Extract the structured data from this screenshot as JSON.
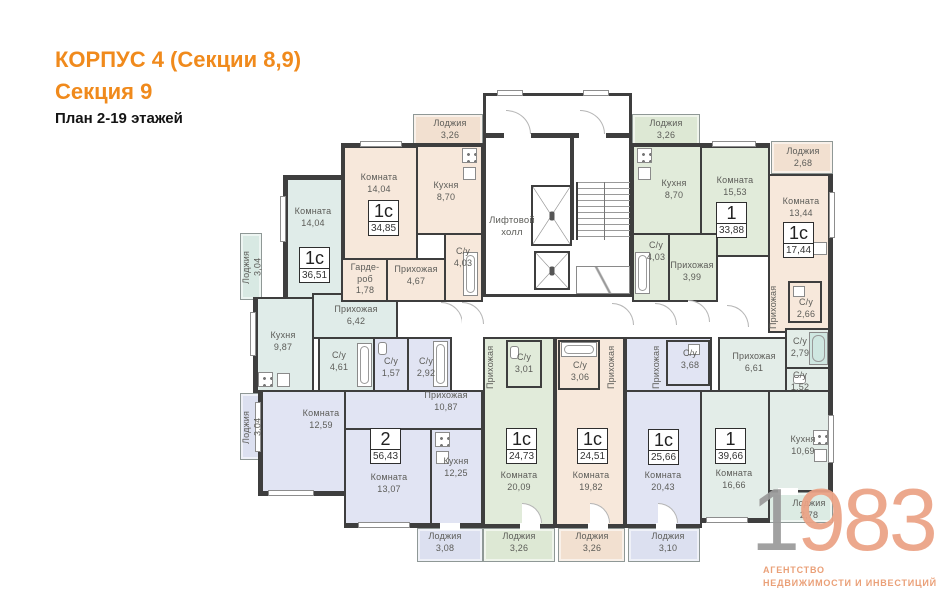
{
  "title": {
    "line1": "КОРПУС 4 (Секции 8,9)",
    "line2": "Секция 9",
    "line3": "План 2-19 этажей"
  },
  "plan": {
    "lift_hall": "Лифтовой холл",
    "apartments": {
      "a3651": {
        "type": "1с",
        "area": "36,51"
      },
      "a3485": {
        "type": "1с",
        "area": "34,85"
      },
      "a3388": {
        "type": "1",
        "area": "33,88"
      },
      "a1744": {
        "type": "1с",
        "area": "17,44"
      },
      "a5643": {
        "type": "2",
        "area": "56,43"
      },
      "a2473": {
        "type": "1с",
        "area": "24,73"
      },
      "a2451": {
        "type": "1с",
        "area": "24,51"
      },
      "a2566": {
        "type": "1с",
        "area": "25,66"
      },
      "a3966": {
        "type": "1",
        "area": "39,66"
      }
    },
    "rooms": {
      "komnataA": {
        "name": "Комната",
        "area": "14,04"
      },
      "lodge304t": {
        "name": "Лоджия",
        "area": "3,04"
      },
      "kuhnya987": {
        "name": "Кухня",
        "area": "9,87"
      },
      "prihozhaya642": {
        "name": "Прихожая",
        "area": "6,42"
      },
      "su461": {
        "name": "С/у",
        "area": "4,61"
      },
      "lodge326tl": {
        "name": "Лоджия",
        "area": "3,26"
      },
      "komnataB": {
        "name": "Комната",
        "area": "14,04"
      },
      "kuhnya870l": {
        "name": "Кухня",
        "area": "8,70"
      },
      "garderob178": {
        "name": "Гарде-роб",
        "area": "1,78"
      },
      "prihozhaya467": {
        "name": "Прихожая",
        "area": "4,67"
      },
      "su403l": {
        "name": "С/у",
        "area": "4,03"
      },
      "lodge326tr": {
        "name": "Лоджия",
        "area": "3,26"
      },
      "kuhnya870r": {
        "name": "Кухня",
        "area": "8,70"
      },
      "komnata1553": {
        "name": "Комната",
        "area": "15,53"
      },
      "su403r": {
        "name": "С/у",
        "area": "4,03"
      },
      "prihozhaya399": {
        "name": "Прихожая",
        "area": "3,99"
      },
      "lodge268": {
        "name": "Лоджия",
        "area": "2,68"
      },
      "komnata1344": {
        "name": "Комната",
        "area": "13,44"
      },
      "prihozhaya1744": {
        "name": "Прихожая",
        "area": ""
      },
      "su266": {
        "name": "С/у",
        "area": "2,66"
      },
      "su279": {
        "name": "С/у",
        "area": "2,79"
      },
      "su152": {
        "name": "С/у",
        "area": "1,52"
      },
      "prihozhaya661": {
        "name": "Прихожая",
        "area": "6,61"
      },
      "kuhnya1069": {
        "name": "Кухня",
        "area": "10,69"
      },
      "komnata1666": {
        "name": "Комната",
        "area": "16,66"
      },
      "lodge278": {
        "name": "Лоджия",
        "area": "2,78"
      },
      "komnata1259": {
        "name": "Комната",
        "area": "12,59"
      },
      "lodge304b": {
        "name": "Лоджия",
        "area": "3,04"
      },
      "su157": {
        "name": "С/у",
        "area": "1,57"
      },
      "su292": {
        "name": "С/у",
        "area": "2,92"
      },
      "prihozhaya1087": {
        "name": "Прихожая",
        "area": "10,87"
      },
      "komnata1307": {
        "name": "Комната",
        "area": "13,07"
      },
      "kuhnya1225": {
        "name": "Кухня",
        "area": "12,25"
      },
      "lodge308": {
        "name": "Лоджия",
        "area": "3,08"
      },
      "prihozhayaV1": {
        "name": "Прихожая",
        "area": ""
      },
      "su301": {
        "name": "С/у",
        "area": "3,01"
      },
      "komnata2009": {
        "name": "Комната",
        "area": "20,09"
      },
      "lodge326b1": {
        "name": "Лоджия",
        "area": "3,26"
      },
      "su306": {
        "name": "С/у",
        "area": "3,06"
      },
      "prihozhayaV2": {
        "name": "Прихожая",
        "area": ""
      },
      "komnata1982": {
        "name": "Комната",
        "area": "19,82"
      },
      "lodge326b2": {
        "name": "Лоджия",
        "area": "3,26"
      },
      "prihozhayaV3": {
        "name": "Прихожая",
        "area": ""
      },
      "su368": {
        "name": "С/у",
        "area": "3,68"
      },
      "komnata2043": {
        "name": "Комната",
        "area": "20,43"
      },
      "lodge310": {
        "name": "Лоджия",
        "area": "3,10"
      }
    },
    "colors": {
      "wall": "#3e3e3e",
      "beige": "#f7e8db",
      "green": "#e1ebda",
      "cyan": "#e0ece9",
      "lavender": "#e1e4f3",
      "teal": "#e3ede8",
      "title_orange": "#f08a1c"
    }
  },
  "logo": {
    "one": "1",
    "rest": "983",
    "agency1": "АГЕНТСТВО",
    "agency2": "НЕДВИЖИМОСТИ И ИНВЕСТИЦИЙ",
    "salmon": "#eba285"
  }
}
